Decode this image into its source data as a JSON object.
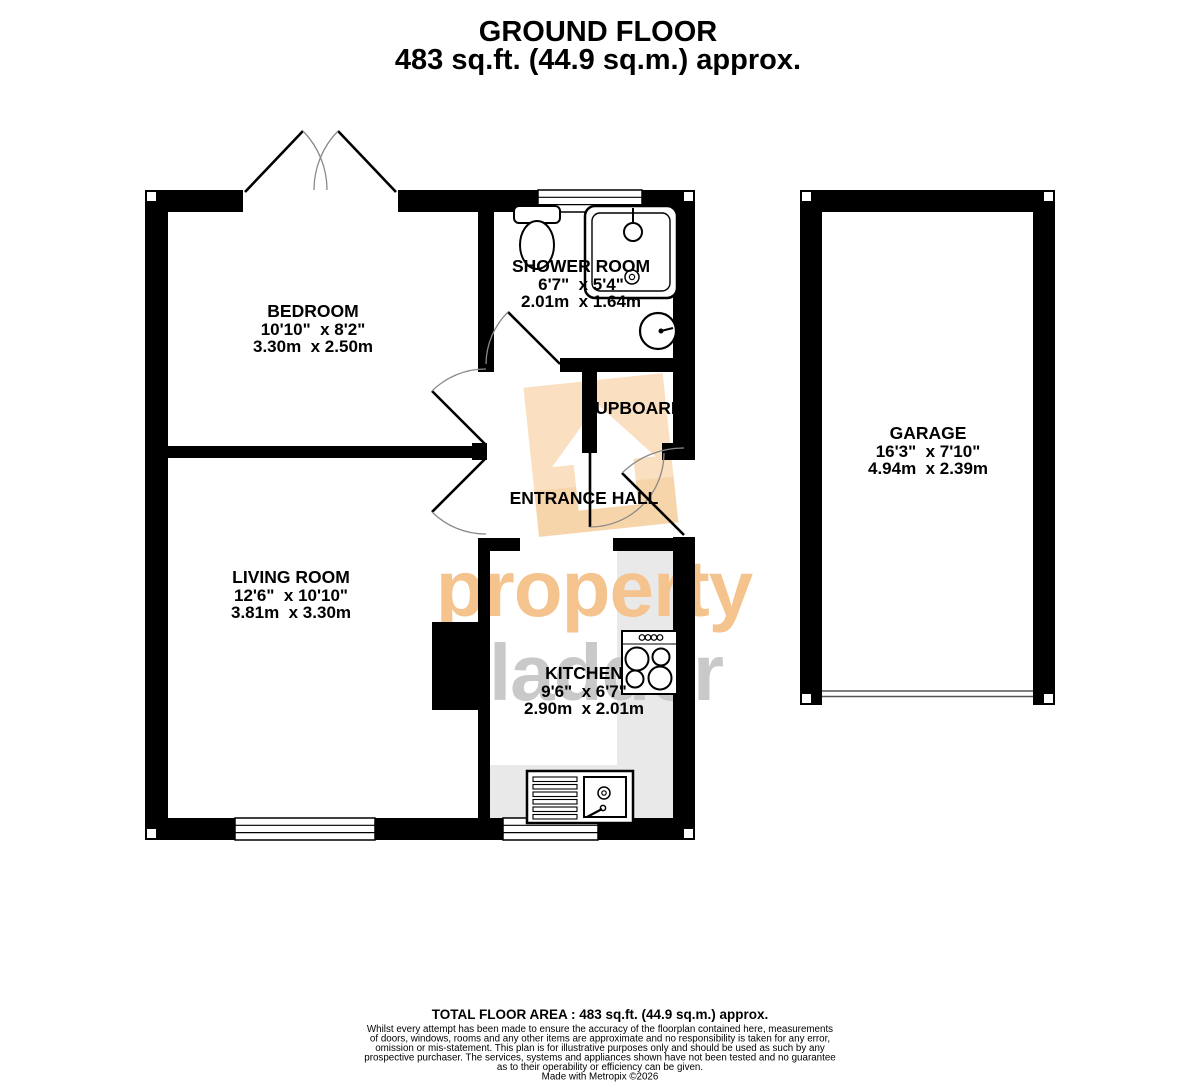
{
  "title": {
    "line1": "GROUND FLOOR",
    "line2": "483 sq.ft. (44.9 sq.m.) approx."
  },
  "rooms": {
    "bedroom": {
      "name": "BEDROOM",
      "imperial": "10'10\"  x 8'2\"",
      "metric": "3.30m  x 2.50m"
    },
    "shower_room": {
      "name": "SHOWER ROOM",
      "imperial": "6'7\"  x 5'4\"",
      "metric": "2.01m  x 1.64m"
    },
    "cupboard": {
      "name": "CUPBOARD"
    },
    "entrance_hall": {
      "name": "ENTRANCE HALL"
    },
    "living_room": {
      "name": "LIVING ROOM",
      "imperial": "12'6\"  x 10'10\"",
      "metric": "3.81m  x 3.30m"
    },
    "kitchen": {
      "name": "KITCHEN",
      "imperial": "9'6\"  x 6'7\"",
      "metric": "2.90m  x 2.01m"
    },
    "garage": {
      "name": "GARAGE",
      "imperial": "16'3\"  x 7'10\"",
      "metric": "4.94m  x 2.39m"
    }
  },
  "watermark": {
    "word1": "property",
    "word2": "ladder",
    "orange": "#f5c38e",
    "logo_orange": "#fadfc0",
    "gray": "#c9c9c9"
  },
  "footer": {
    "total": "TOTAL FLOOR AREA : 483 sq.ft. (44.9 sq.m.) approx.",
    "disclaimer": [
      "Whilst every attempt has been made to ensure the accuracy of the floorplan contained here, measurements",
      "of doors, windows, rooms and any other items are approximate and no responsibility is taken for any error,",
      "omission or mis-statement. This plan is for illustrative purposes only and should be used as such by any",
      "prospective purchaser. The services, systems and appliances shown have not been tested and no guarantee",
      "as to their operability or efficiency can be given."
    ],
    "credit": "Made with Metropix ©2026"
  },
  "colors": {
    "wall": "#000000",
    "counter_gray": "#e9e9e9",
    "door_arc_gray": "#8a8a8a"
  }
}
